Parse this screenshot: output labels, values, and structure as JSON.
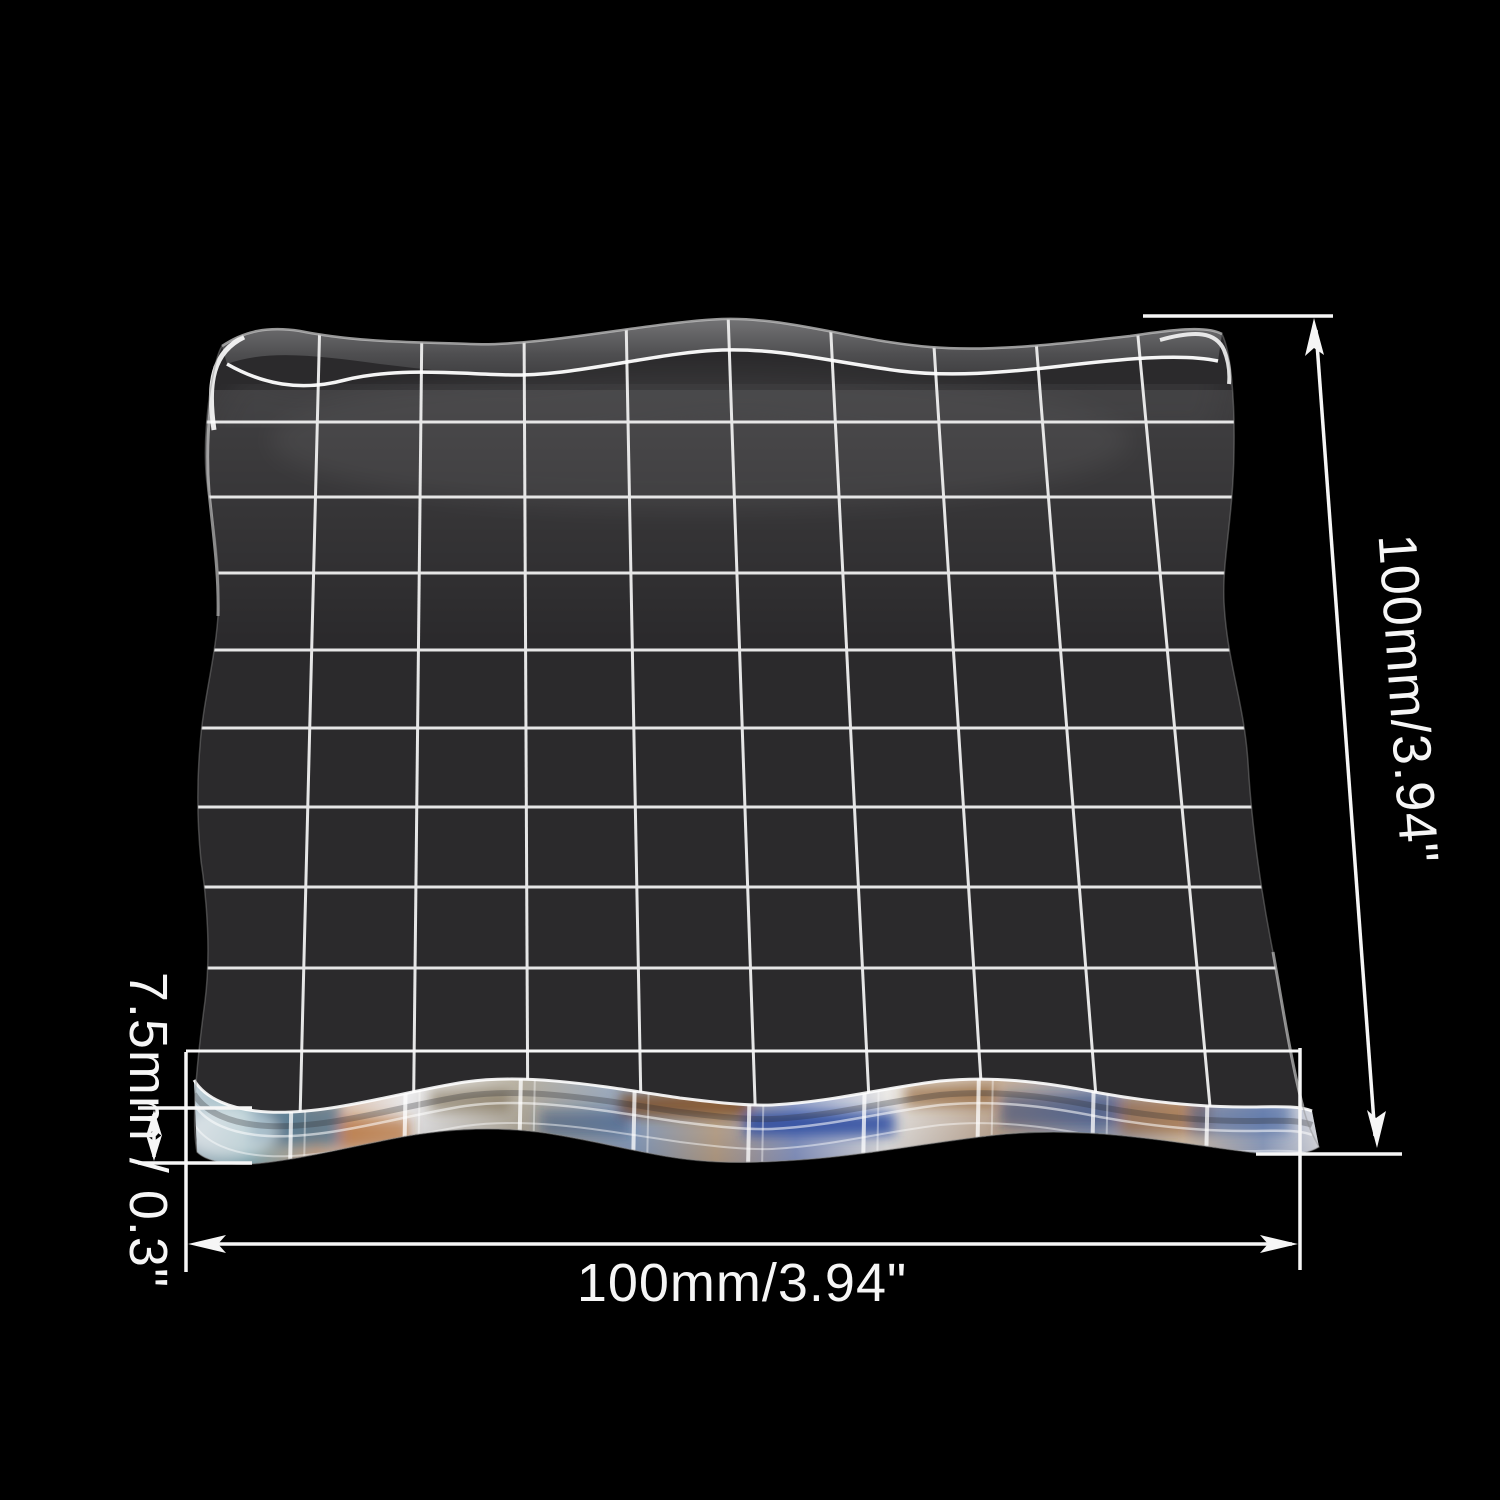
{
  "scene": {
    "background_color": "#000000",
    "subject": "transparent acrylic stamp block with etched alignment grid, annotated with measurements"
  },
  "block": {
    "surface_color": "#2b2a2c",
    "grid_line_color": "#e6e6e6",
    "grid_columns": 10,
    "grid_rows": 10,
    "edge_style": "wavy scalloped edges, clear acrylic with iridescent bottom edge"
  },
  "annotations": {
    "color": "#f6f6f6",
    "height": {
      "label": "100mm/3.94\""
    },
    "width": {
      "label": "100mm/3.94\""
    },
    "thickness": {
      "label": "7.5mm / 0.3\""
    }
  }
}
